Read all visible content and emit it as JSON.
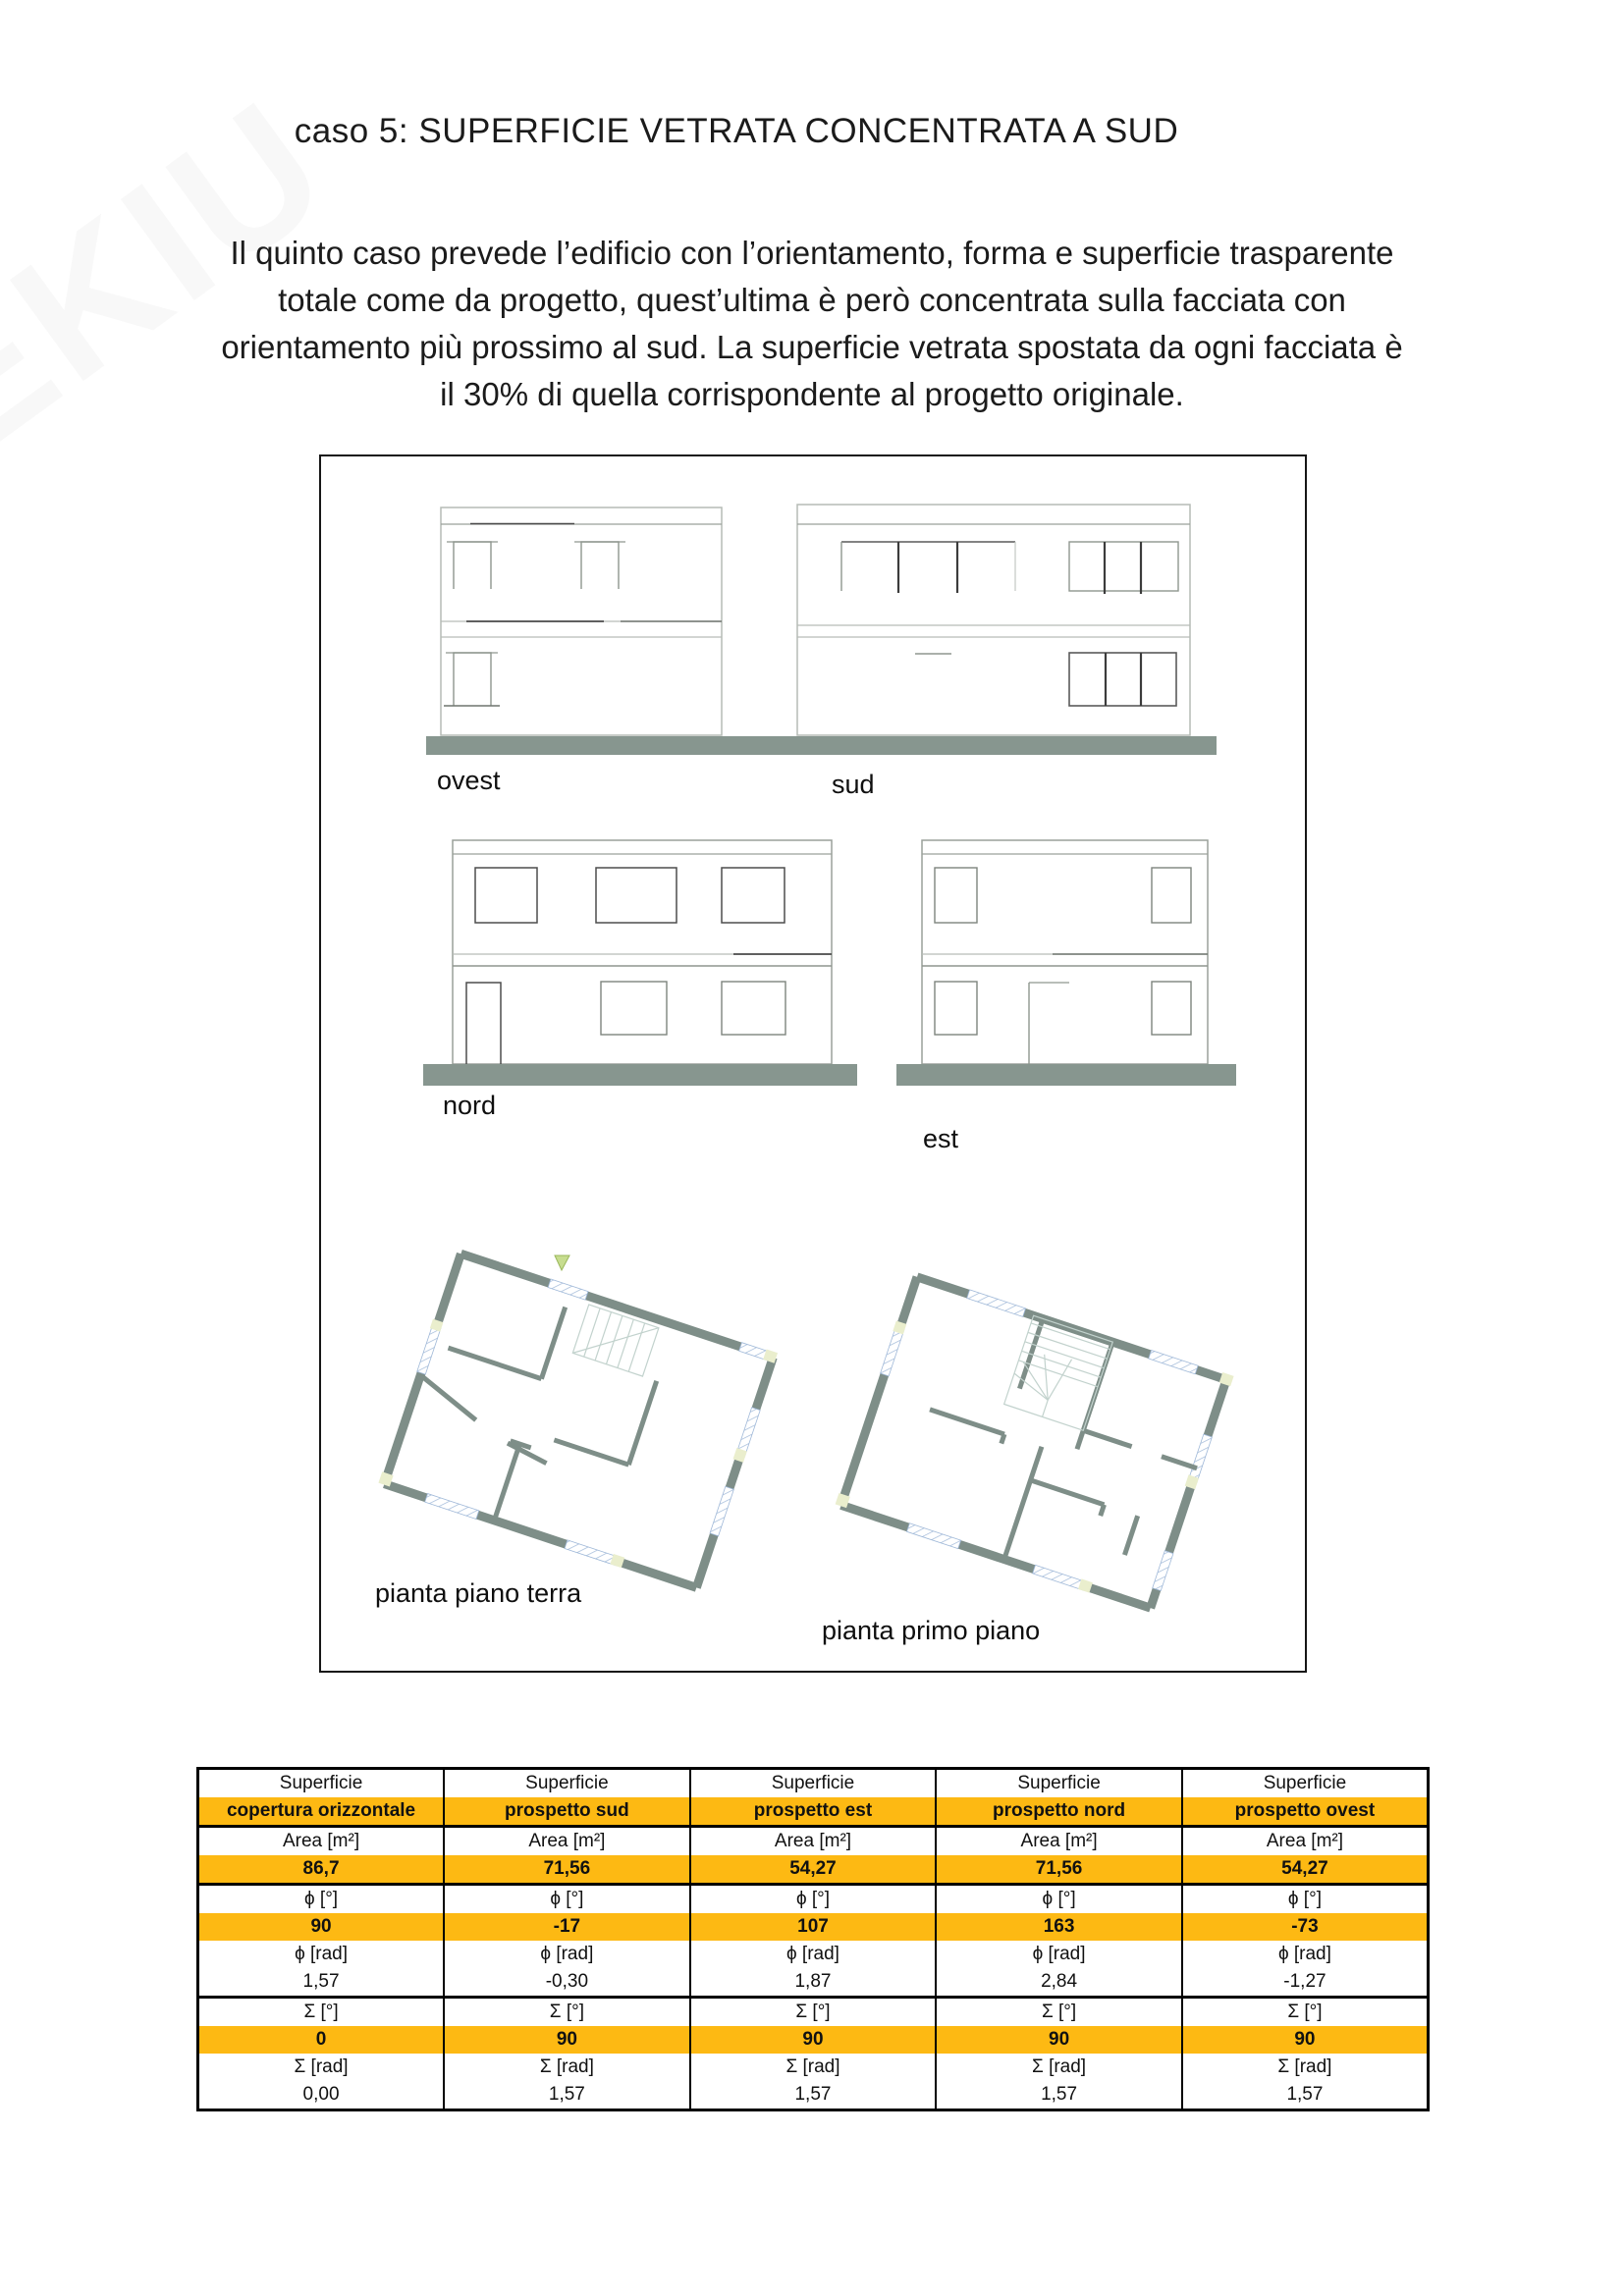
{
  "page": {
    "title": "caso 5: SUPERFICIE VETRATA CONCENTRATA A SUD",
    "watermark": "EKIU",
    "paragraph_lines": [
      "Il quinto caso prevede l’edificio con l’orientamento, forma e superficie trasparente",
      "totale come da progetto, quest’ultima è però concentrata sulla facciata con",
      "orientamento più prossimo al sud. La superficie vetrata spostata da ogni facciata è",
      "il 30% di quella corrispondente al progetto originale."
    ]
  },
  "figure": {
    "elevations": [
      {
        "label": "ovest"
      },
      {
        "label": "sud"
      },
      {
        "label": "nord"
      },
      {
        "label": "est"
      }
    ],
    "plans": [
      {
        "label": "pianta piano terra"
      },
      {
        "label": "pianta primo piano"
      }
    ]
  },
  "table": {
    "row_labels": {
      "superficie": "Superficie",
      "area": "Area [m²]",
      "phi_deg": "ϕ [°]",
      "phi_rad": "ϕ [rad]",
      "sigma_deg": "Σ [°]",
      "sigma_rad": "Σ [rad]"
    },
    "columns": [
      {
        "header": "Superficie",
        "name": "copertura orizzontale",
        "area": "86,7",
        "phi_deg": "90",
        "phi_rad": "1,57",
        "sigma_deg": "0",
        "sigma_rad": "0,00"
      },
      {
        "header": "Superficie",
        "name": "prospetto sud",
        "area": "71,56",
        "phi_deg": "-17",
        "phi_rad": "-0,30",
        "sigma_deg": "90",
        "sigma_rad": "1,57"
      },
      {
        "header": "Superficie",
        "name": "prospetto est",
        "area": "54,27",
        "phi_deg": "107",
        "phi_rad": "1,87",
        "sigma_deg": "90",
        "sigma_rad": "1,57"
      },
      {
        "header": "Superficie",
        "name": "prospetto nord",
        "area": "71,56",
        "phi_deg": "163",
        "phi_rad": "2,84",
        "sigma_deg": "90",
        "sigma_rad": "1,57"
      },
      {
        "header": "Superficie",
        "name": "prospetto ovest",
        "area": "54,27",
        "phi_deg": "-73",
        "phi_rad": "-1,27",
        "sigma_deg": "90",
        "sigma_rad": "1,57"
      }
    ]
  },
  "colors": {
    "accent_orange": "#FDB913",
    "ground_bar": "#87968F",
    "plan_wall": "#7E8E88",
    "opening_hatch_blue": "#9FB8D8",
    "end_block": "#EAEECD",
    "marker_green": "#C7DD8F"
  }
}
